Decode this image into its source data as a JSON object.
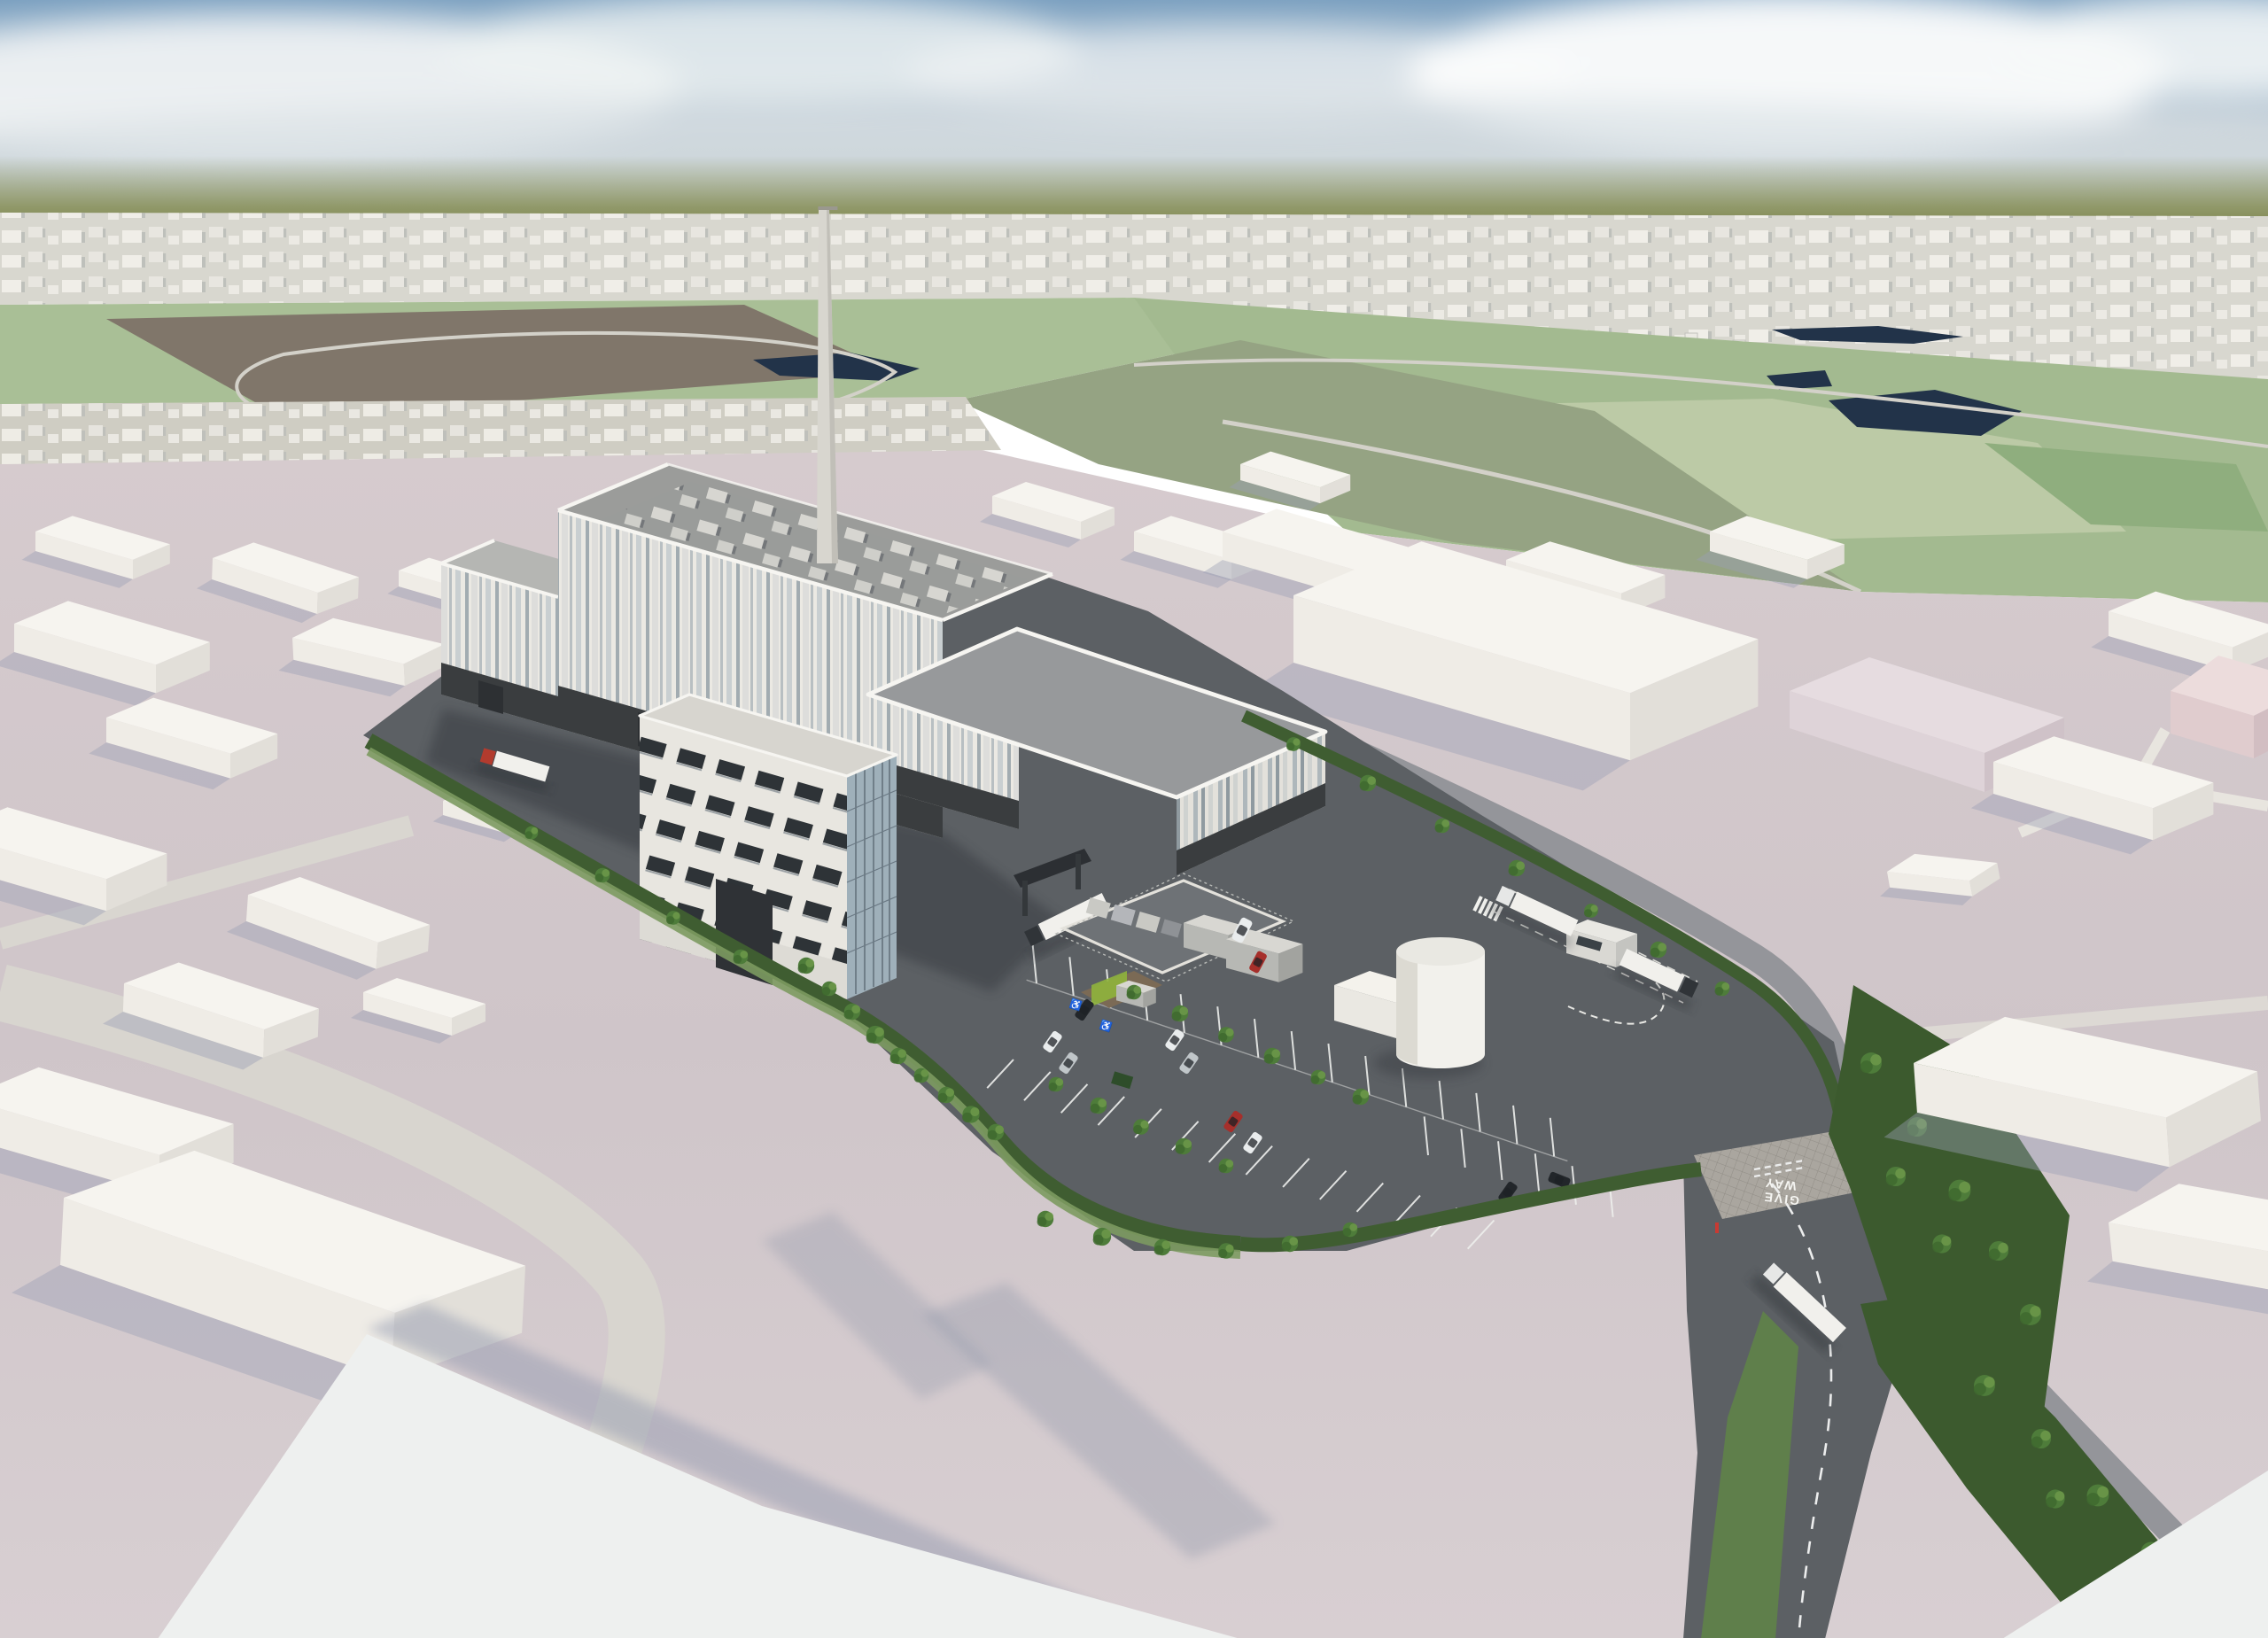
{
  "meta": {
    "title": "Aerial CGI visualisation of a proposed industrial facility",
    "media": "3D architectural massing render",
    "view": "high oblique aerial view over a white city context model"
  },
  "road_markings": {
    "give_way_text": "GIVE WAY",
    "give_way_lines": [
      "GIVE",
      "WAY"
    ],
    "centreline": "short dashed white centreline",
    "hgv_route": "U-shaped dashed weighbridge lane loop",
    "accessible_bay_symbol": "♿"
  },
  "scene": {
    "sky": "pale hazy blue sky with soft clouds over an olive-green horizon band",
    "background": [
      "dense white low-rise cityscape stretching to the horizon",
      "green playing fields crossed by pale paths",
      "dark navy ponds in parkland",
      "brown earth field at left",
      "cluster of white tower blocks at right"
    ],
    "midground": [
      "pink-grey ground plane",
      "plain white context massing blocks casting blue-grey shadows",
      "pale existing roads"
    ],
    "site": {
      "plot": "elongated landscaped plot edged with clipped hedges and trees",
      "surfacing": "dark asphalt service yard, parking court and access road",
      "buildings": [
        {
          "name": "main process hall",
          "features": "tallest volume, vertical white/grey striped cladding, dark plinth with doors, rooftop plant deck, slender flue stack"
        },
        {
          "name": "secondary hall",
          "features": "large grey flat roof with white parapet, striped cladding"
        },
        {
          "name": "office block",
          "floors": 6,
          "features": "dark ribbon windows, glazed corner stair tower, ground-level archway"
        },
        {
          "name": "rear service wing",
          "features": "lower striped volume over loading apron"
        },
        {
          "name": "transformer compound",
          "features": "walled and fenced enclosure with grey electrical plant"
        },
        {
          "name": "ancillary kiosks",
          "count": 3
        },
        {
          "name": "gatehouse cabin",
          "features": "flat-roof cabin between weighbridge lanes"
        },
        {
          "name": "cylindrical storage tank",
          "color": "white"
        }
      ],
      "parking": {
        "marked_bays": 36,
        "accessible_bays": 2,
        "tree_planting": "single trees between bays",
        "occupied_by": [
          "white car",
          "silver car",
          "black car",
          "white car",
          "silver car",
          "red car",
          "white car",
          "black car"
        ]
      },
      "vehicles": [
        {
          "type": "articulated lorry",
          "cab": "red",
          "location": "western loading apron"
        },
        {
          "type": "articulated lorry",
          "cab": "black",
          "location": "beneath corner gantry"
        },
        {
          "type": "articulated lorry",
          "cab": "white",
          "location": "inbound gatehouse lane"
        },
        {
          "type": "articulated lorry",
          "cab": "black",
          "location": "outbound gatehouse lane"
        },
        {
          "type": "articulated lorry",
          "cab": "white",
          "location": "access road approaching the site"
        },
        {
          "type": "van",
          "color": "white",
          "location": "transformer compound"
        },
        {
          "type": "car",
          "color": "red",
          "location": "transformer compound"
        },
        {
          "type": "car",
          "color": "black",
          "location": "junction by the site entrance"
        }
      ],
      "landscape": [
        "clipped hedge around the plot",
        "woodland belt east of the access road",
        "grass verges",
        "zebra crossing at the gatehouse",
        "block-paved entrance junction"
      ]
    }
  },
  "palette": {
    "sky_top": "#7ba0c0",
    "sky_haze": "#c9d3da",
    "sky_low": "#c2cbc6",
    "horizon_olive": "#8b935f",
    "ground_pink": "#cfc5c9",
    "ground_pink_far": "#d6cbce",
    "city_block": "#f1efe9",
    "park_green": "#a9bf96",
    "park_green_light": "#bccaa6",
    "park_green_dark": "#8fae7e",
    "pond_navy": "#223349",
    "field_brown": "#80766a",
    "road_light": "#dbd8d2",
    "road_public_grey": "#94959a",
    "site_asphalt": "#5c6064",
    "hedge_green": "#3f5d31",
    "woodland_green": "#3c5a2e",
    "tree_green": "#4e7c3a",
    "grass_verge": "#7c9a60",
    "cladding_white": "#ebe9e3",
    "cladding_grey": "#a9b2b7",
    "plinth_dark": "#3a3d3f",
    "roof_grey": "#97999b",
    "office_roof": "#d7d5cf",
    "window_dark": "#2e3337",
    "glass_blue": "#9fb0ba",
    "stack_grey": "#d8d6cf",
    "tank_white": "#f2f1ec",
    "parapet_white": "#f6f5f1",
    "line_white": "#f5f5f2",
    "shadow_blue": "#8f96ad",
    "shadow_dark": "#2e3237",
    "truck_trailer_white": "#f1f0ec",
    "truck_cab_red": "#b23b2e",
    "truck_cab_dark": "#303438",
    "car_white": "#e9eced",
    "car_silver": "#c0c6c9",
    "car_red": "#a62f2b",
    "car_black": "#22262a",
    "lavender_block": "#ded3d8"
  }
}
